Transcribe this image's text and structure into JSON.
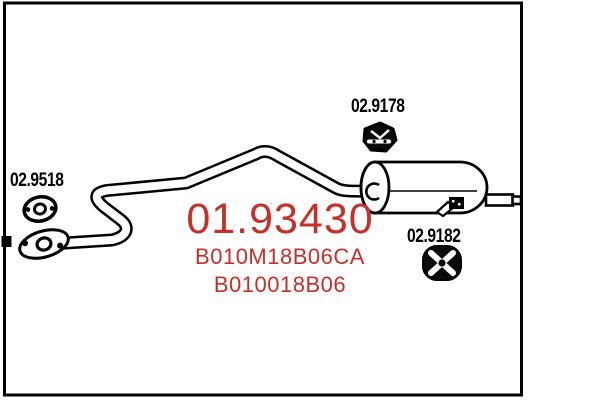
{
  "diagram": {
    "title": "exhaust-rear-silencer-diagram",
    "main_part_number": "01.93430",
    "oe_references": [
      "B010M18B06CA",
      "B010018B06"
    ],
    "components": [
      {
        "id": "front-gasket",
        "label": "02.9518",
        "icon": "gasket-ring-icon"
      },
      {
        "id": "mounting-clamp",
        "label": "02.9178",
        "icon": "clamp-icon"
      },
      {
        "id": "rubber-mount",
        "label": "02.9182",
        "icon": "rubber-mount-icon"
      }
    ],
    "colors": {
      "highlight_red": "#c62f2a",
      "line_black": "#000000",
      "background": "#ffffff"
    }
  }
}
